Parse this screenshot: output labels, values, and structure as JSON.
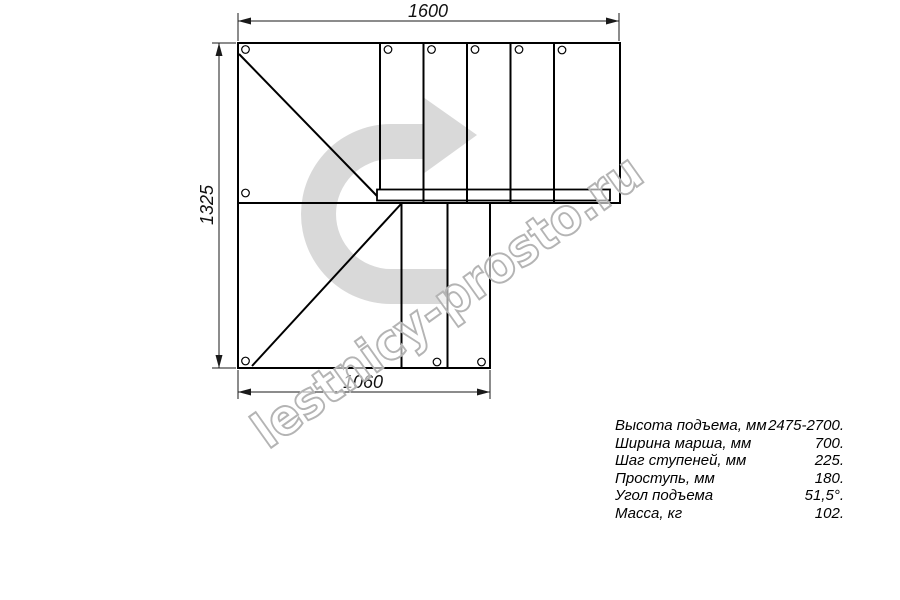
{
  "drawing": {
    "title": "L-shaped staircase plan view",
    "dimensions": {
      "top": "1600",
      "left": "1325",
      "bottom": "1060"
    }
  },
  "watermark": {
    "text": "lestnicy-prosto.ru"
  },
  "specs": {
    "rows": [
      {
        "label": "Высота подъема, мм",
        "value": "2475-2700."
      },
      {
        "label": "Ширина марша, мм",
        "value": "700."
      },
      {
        "label": "Шаг ступеней, мм",
        "value": "225."
      },
      {
        "label": "Проступь, мм",
        "value": "180."
      },
      {
        "label": "Угол подъема",
        "value": "51,5°."
      },
      {
        "label": "Масса, кг",
        "value": "102."
      }
    ]
  },
  "colors": {
    "line": "#000000",
    "dimension": "#1a1a1a",
    "watermark_arrow": "#d9d9d9",
    "watermark_text_outline": "#b4b4b4"
  }
}
